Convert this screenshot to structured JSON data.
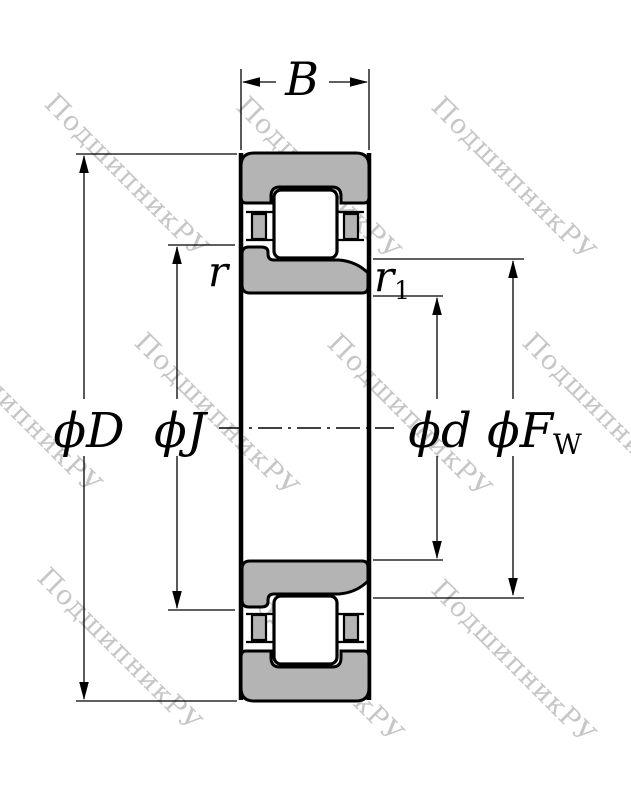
{
  "watermark": {
    "text": "ПодшипникРУ",
    "color": "#c6c6c6"
  },
  "colors": {
    "steel_gray": "#b4b4b4",
    "line_black": "#000000",
    "roller_white": "#ffffff",
    "background": "#ffffff"
  },
  "dimension_labels": {
    "width": "B",
    "outer_diameter": "ϕD",
    "inner_rib_diameter": "ϕJ",
    "bore_diameter": "ϕd",
    "raceway_diameter_main": "ϕF",
    "raceway_diameter_sub": "W",
    "chamfer_outer": "r",
    "chamfer_inner_main": "r",
    "chamfer_inner_sub": "1"
  }
}
